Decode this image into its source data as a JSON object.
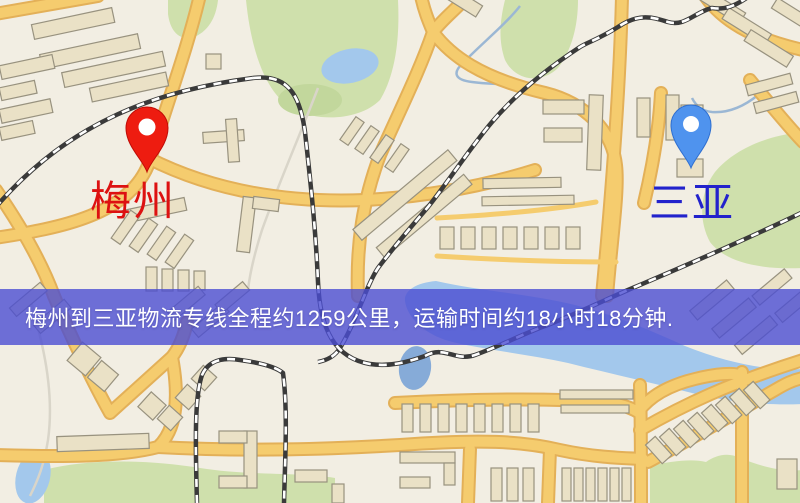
{
  "map": {
    "palette": {
      "background": "#f2eee3",
      "road": "#f5cc6e",
      "road_casing": "#e3b058",
      "building_fill": "#eae1c6",
      "building_stroke": "#98927f",
      "green": "#cfe0ac",
      "water": "#a3c8ec",
      "railway_dark": "#3a3a3a",
      "railway_light": "#ffffff"
    },
    "markers": {
      "origin": {
        "label": "梅州",
        "label_color": "#dd1111",
        "pin_color": "#ee1c10",
        "pin_stroke": "#c00c06"
      },
      "destination": {
        "label": "三亚",
        "label_color": "#2222cc",
        "pin_color": "#4f93ee",
        "pin_stroke": "#2f6fd0"
      }
    },
    "banner": {
      "text": "梅州到三亚物流专线全程约1259公里，运输时间约18小时18分钟.",
      "background": "rgba(75,77,210,0.80)",
      "text_color": "#ffffff"
    }
  }
}
